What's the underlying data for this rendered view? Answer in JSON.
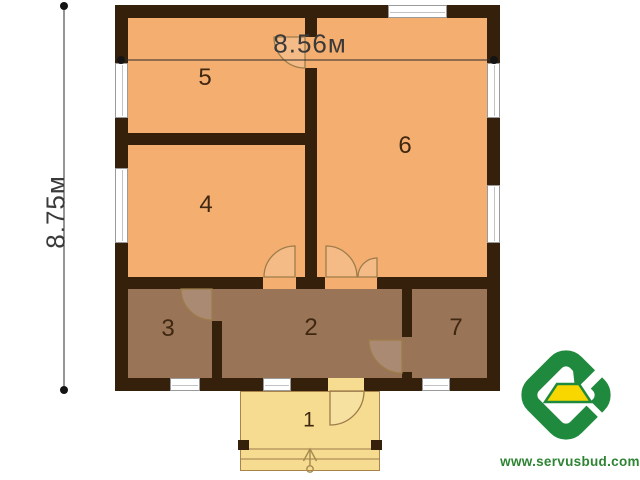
{
  "dimensions": {
    "width_label": "8.56м",
    "height_label": "8.75м"
  },
  "rooms": [
    {
      "label": "1"
    },
    {
      "label": "2"
    },
    {
      "label": "3"
    },
    {
      "label": "4"
    },
    {
      "label": "5"
    },
    {
      "label": "6"
    },
    {
      "label": "7"
    }
  ],
  "branding": {
    "website": "www.servusbud.com"
  },
  "colors": {
    "wall": "#35210b",
    "room_main": "#f4ae70",
    "room_service": "#9a7457",
    "porch": "#f5dc90",
    "door": "#9d7c4a",
    "label_color": "#3f2711",
    "dim_color": "#3a3a3a",
    "logo_green": "#1f8a3d",
    "logo_yellow": "#f8d700",
    "site_green": "#2e8433"
  }
}
